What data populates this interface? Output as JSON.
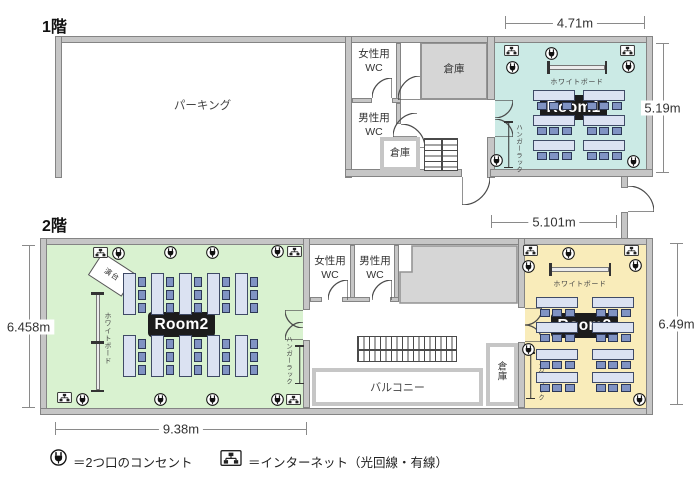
{
  "floor1": {
    "label": "1階",
    "parking_label": "パーキング",
    "wc_female_label": "女性用\nWC",
    "wc_male_label": "男性用\nWC",
    "storage_large_label": "倉庫",
    "storage_small_label": "倉庫",
    "room1": {
      "name": "Room1",
      "whiteboard_label": "ホワイトボード",
      "hanger_rack_label": "ハンガーラック"
    },
    "dimensions": {
      "top_width": "4.71m",
      "right_height": "5.19m",
      "entrance_width": "5.101m"
    }
  },
  "floor2": {
    "label": "2階",
    "wc_female_label": "女性用\nWC",
    "wc_male_label": "男性用\nWC",
    "balcony_label": "バルコニー",
    "storage_label": "倉庫",
    "room2": {
      "name": "Room2",
      "whiteboard_label": "ホワイトボード",
      "hanger_rack_label": "ハンガーラック",
      "podium_label": "演台"
    },
    "room3": {
      "name": "Room3",
      "whiteboard_label": "ホワイトボード",
      "hanger_rack_label": "ハンガーラック"
    },
    "dimensions": {
      "left_height": "6.458m",
      "right_height": "6.49m",
      "bottom_width": "9.38m"
    }
  },
  "legend": {
    "outlet_label": "＝2つ口のコンセント",
    "internet_label": "＝インターネット（光回線・有線）"
  },
  "icons": {
    "outlet": "outlet-icon",
    "internet": "internet-icon"
  },
  "furniture": {
    "room1": {
      "tables": 6,
      "chairs_per_table": 3
    },
    "room2": {
      "tables": 10,
      "chairs_per_table": 3
    },
    "room3": {
      "tables": 8,
      "chairs_per_table": 3
    }
  },
  "colors": {
    "wall": "#c6c6c6",
    "room1": "#cbeae5",
    "room2": "#d9f2d0",
    "room3": "#f9ecba",
    "gray_area": "#d6d6d6",
    "table": "#dbe2f2",
    "chair": "#8093c3",
    "room_chip": "#1c1c1c",
    "dimension": "#8a8a8a"
  }
}
